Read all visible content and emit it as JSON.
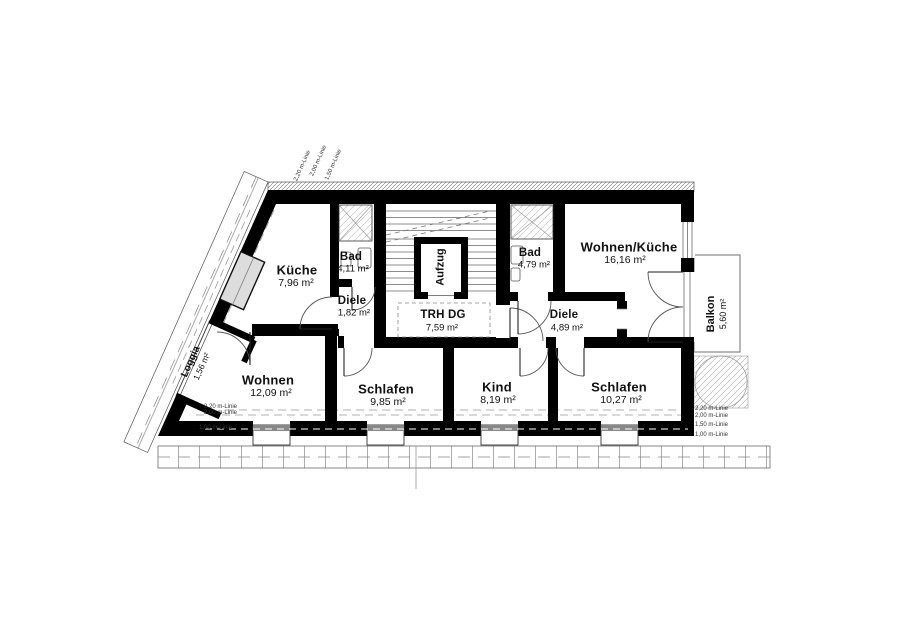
{
  "drawing": {
    "rooms": [
      {
        "id": "kueche",
        "name": "Küche",
        "area": "7,96 m²"
      },
      {
        "id": "bad-a",
        "name": "Bad",
        "area": "4,11 m²"
      },
      {
        "id": "diele-a",
        "name": "Diele",
        "area": "1,82 m²"
      },
      {
        "id": "trh",
        "name": "TRH DG",
        "area": "7,59 m²"
      },
      {
        "id": "aufzug",
        "name": "Aufzug",
        "area": ""
      },
      {
        "id": "bad-b",
        "name": "Bad",
        "area": "4,79 m²"
      },
      {
        "id": "wohnen-kueche",
        "name": "Wohnen/Küche",
        "area": "16,16 m²"
      },
      {
        "id": "diele-b",
        "name": "Diele",
        "area": "4,89 m²"
      },
      {
        "id": "balkon",
        "name": "Balkon",
        "area": "5,60 m²"
      },
      {
        "id": "loggia",
        "name": "Loggia",
        "area": "1,56 m²"
      },
      {
        "id": "wohnen",
        "name": "Wohnen",
        "area": "12,09 m²"
      },
      {
        "id": "schlafen-a",
        "name": "Schlafen",
        "area": "9,85 m²"
      },
      {
        "id": "kind",
        "name": "Kind",
        "area": "8,19 m²"
      },
      {
        "id": "schlafen-b",
        "name": "Schlafen",
        "area": "10,27 m²"
      }
    ],
    "height_lines": {
      "right_0": "2,20 m-Linie",
      "right_1": "2,00 m-Linie",
      "right_2": "1,50 m-Linie",
      "right_3": "1,00 m-Linie",
      "left_0": "2,20 m-Linie",
      "left_1": "2,00 m-Linie",
      "left_2": "1,00 m-Linie",
      "top_0": "2,20 m-Linie",
      "top_1": "2,00 m-Linie",
      "top_2": "1,50 m-Linie"
    }
  }
}
